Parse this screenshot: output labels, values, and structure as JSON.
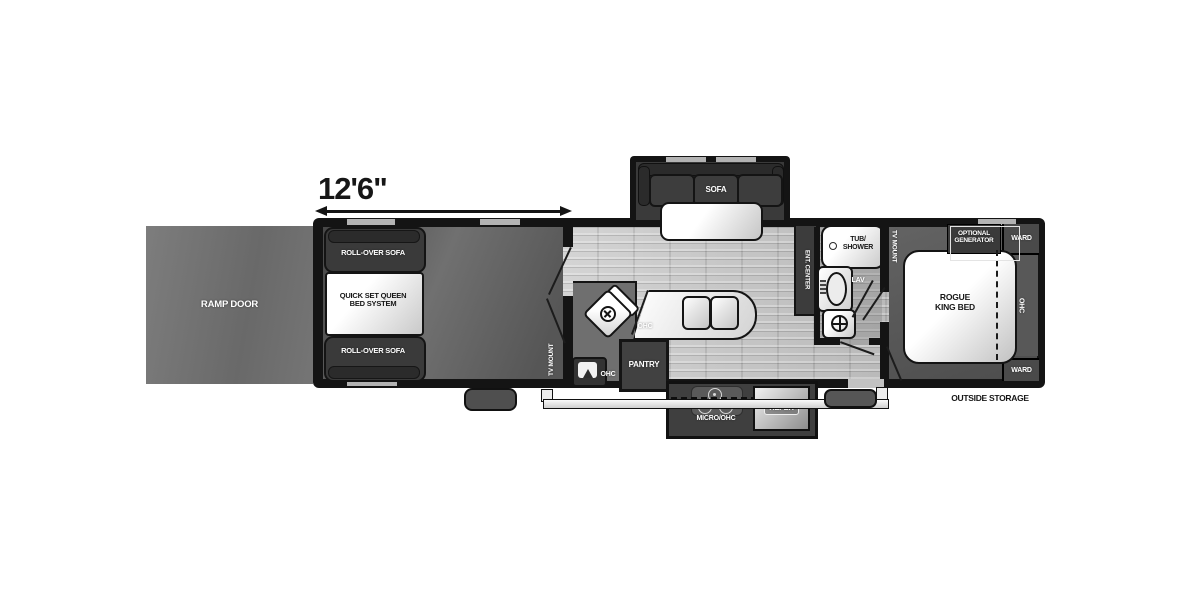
{
  "dimension": {
    "label": "12'6\""
  },
  "exterior": {
    "ramp_door": "RAMP DOOR",
    "outside_storage": "OUTSIDE STORAGE"
  },
  "garage": {
    "rollover_sofa_top": "ROLL-OVER SOFA",
    "rollover_sofa_bottom": "ROLL-OVER SOFA",
    "queen_bed_line1": "QUICK SET QUEEN",
    "queen_bed_line2": "BED SYSTEM",
    "tv_mount": "TV MOUNT",
    "ohc": "OHC"
  },
  "kitchen": {
    "sofa": "SOFA",
    "ohc": "OHC",
    "pantry": "PANTRY",
    "ent_center": "ENT. CENTER",
    "micro_ohc": "MICRO/OHC",
    "refer": "REFER"
  },
  "bathroom": {
    "tub_line1": "TUB/",
    "tub_line2": "SHOWER",
    "lav": "LAV"
  },
  "bedroom": {
    "tv_mount": "TV MOUNT",
    "optional_generator_line1": "OPTIONAL",
    "optional_generator_line2": "GENERATOR",
    "ward_top": "WARD",
    "king_bed_line1": "ROGUE",
    "king_bed_line2": "KING BED",
    "ohc": "OHC",
    "ward_bottom": "WARD"
  },
  "colors": {
    "wall": "#141414",
    "dark_floor": "#5a5a5a",
    "light_floor": "#c9c9c9",
    "furniture_dark": "#3c3c3c",
    "furniture_light": "#ffffff"
  }
}
